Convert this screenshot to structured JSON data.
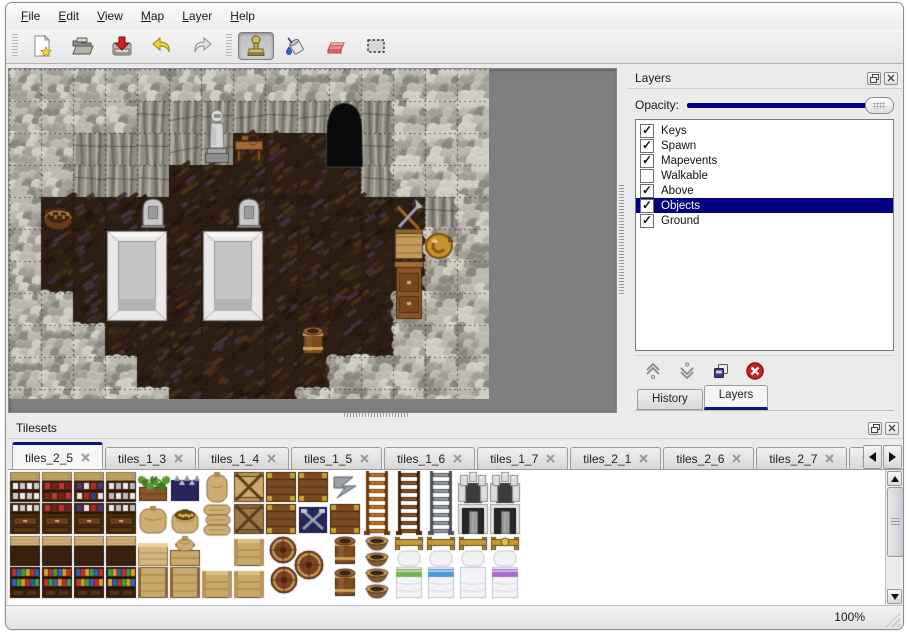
{
  "menu": {
    "items": [
      {
        "label": "File"
      },
      {
        "label": "Edit"
      },
      {
        "label": "View"
      },
      {
        "label": "Map"
      },
      {
        "label": "Layer"
      },
      {
        "label": "Help"
      }
    ],
    "underline_index": 0
  },
  "toolbar": {
    "buttons": [
      {
        "id": "new",
        "icon": "new-file-icon",
        "active": false
      },
      {
        "id": "open",
        "icon": "open-folder-icon",
        "active": false
      },
      {
        "id": "save",
        "icon": "save-icon",
        "active": false
      },
      {
        "id": "undo",
        "icon": "undo-icon",
        "active": false
      },
      {
        "id": "redo",
        "icon": "redo-icon",
        "active": false
      },
      {
        "id": "stamp",
        "icon": "stamp-tool-icon",
        "active": true
      },
      {
        "id": "fill",
        "icon": "fill-tool-icon",
        "active": false
      },
      {
        "id": "eraser",
        "icon": "eraser-tool-icon",
        "active": false
      },
      {
        "id": "select",
        "icon": "rect-select-icon",
        "active": false
      }
    ]
  },
  "layers_panel": {
    "title": "Layers",
    "opacity_label": "Opacity:",
    "opacity_percent": 100,
    "layers": [
      {
        "name": "Keys",
        "checked": true,
        "selected": false
      },
      {
        "name": "Spawn",
        "checked": true,
        "selected": false
      },
      {
        "name": "Mapevents",
        "checked": true,
        "selected": false
      },
      {
        "name": "Walkable",
        "checked": false,
        "selected": false
      },
      {
        "name": "Above",
        "checked": true,
        "selected": false
      },
      {
        "name": "Objects",
        "checked": true,
        "selected": true
      },
      {
        "name": "Ground",
        "checked": true,
        "selected": false
      }
    ],
    "tool_icons": [
      "move-layer-up-icon",
      "move-layer-down-icon",
      "duplicate-layer-icon",
      "delete-layer-icon"
    ],
    "tabs": [
      {
        "label": "History",
        "active": false
      },
      {
        "label": "Layers",
        "active": true
      }
    ]
  },
  "tilesets_panel": {
    "title": "Tilesets",
    "tabs": [
      {
        "label": "tiles_2_5",
        "active": true,
        "partial": false
      },
      {
        "label": "tiles_1_3",
        "active": false,
        "partial": false
      },
      {
        "label": "tiles_1_4",
        "active": false,
        "partial": false
      },
      {
        "label": "tiles_1_5",
        "active": false,
        "partial": false
      },
      {
        "label": "tiles_1_6",
        "active": false,
        "partial": false
      },
      {
        "label": "tiles_1_7",
        "active": false,
        "partial": false
      },
      {
        "label": "tiles_2_1",
        "active": false,
        "partial": false
      },
      {
        "label": "tiles_2_6",
        "active": false,
        "partial": false
      },
      {
        "label": "tiles_2_7",
        "active": false,
        "partial": false
      },
      {
        "label": "tiles_2",
        "active": false,
        "partial": true
      }
    ]
  },
  "statusbar": {
    "zoom_level": "100%"
  },
  "colors": {
    "selection": "#000080",
    "slider_track": "#00008a",
    "tab_accent": "#13137e",
    "map_background": "#7f7f7f"
  },
  "map_view": {
    "tile_size": 32,
    "grid": [
      "WWWWWWWWWWWWWWW",
      "WWWWVVVVVVDVWWW",
      "WWVVVVVFFFDVWWW",
      "WWVVVFFFFFFVWWW",
      "WFFFFFFFFFFFFVW",
      "WFFFFFFFFFFFFWW",
      "WFFFFFFFFFFFFWW",
      "WWFFFFFFFFFFWWW",
      "WWWFFFFFFFFFWWW",
      "WWWWFFFFFFWWWWW",
      "WWWWWFFFFWWWWWW"
    ],
    "objects": [
      {
        "type": "statue",
        "col": 6,
        "row": 1
      },
      {
        "type": "table",
        "col": 7,
        "row": 2
      },
      {
        "type": "door",
        "col": 10,
        "row": 1
      },
      {
        "type": "tombstone",
        "col": 4,
        "row": 4
      },
      {
        "type": "tombstone",
        "col": 7,
        "row": 4
      },
      {
        "type": "altar",
        "col": 3,
        "row": 5
      },
      {
        "type": "altar",
        "col": 6,
        "row": 5
      },
      {
        "type": "basket",
        "col": 1,
        "row": 4
      },
      {
        "type": "barrel",
        "col": 9,
        "row": 8
      },
      {
        "type": "crate-tools",
        "col": 12,
        "row": 4
      },
      {
        "type": "shield",
        "col": 13,
        "row": 5
      },
      {
        "type": "dresser",
        "col": 12,
        "row": 6
      }
    ]
  },
  "tileset_view": {
    "tile_size": 32,
    "rows": [
      [
        "shelfA_top:0",
        "shelfA_top:1",
        "shelfA_top:2",
        "shelfA_top:3",
        "planter",
        "mineralbox",
        "sacktall",
        "cratex:light",
        "planks",
        "planks",
        "metalz",
        "ladder:orange:top",
        "ladder:brown:top",
        "ladder:steel:top",
        "arch",
        "arch"
      ],
      [
        "shelfA_bot:0",
        "shelfA_bot:1",
        "shelfA_bot:2",
        "shelfA_bot:3",
        "sackbig",
        "sackopen",
        "sackpile",
        "cratex:dark",
        "planks",
        "mineralbox2",
        "planks",
        "ladder:orange:bot",
        "ladder:brown:bot",
        "ladder:steel:bot",
        "stonedoor",
        "stonedoor"
      ],
      [
        "shelfB_top:0",
        "shelfB_top:1",
        "shelfB_top:2",
        "shelfB_top:3",
        "counter_top",
        "cratesack",
        ".",
        "crate",
        "barrelpile",
        "skip",
        "barrelup",
        "pots",
        "bed_top:0",
        "bed_top:1",
        "bed_top:2",
        "bed_top:3"
      ],
      [
        "shelfB_bot:0",
        "shelfB_bot:1",
        "shelfB_bot:2",
        "shelfB_bot:3",
        "counter_bot",
        "counter_bot",
        "crate",
        "crate",
        "skip",
        "skip",
        "barrelup",
        "pots",
        "bed_bot:green",
        "bed_bot:blue",
        "bed_bot:plain",
        "bed_bot:purple"
      ]
    ]
  }
}
